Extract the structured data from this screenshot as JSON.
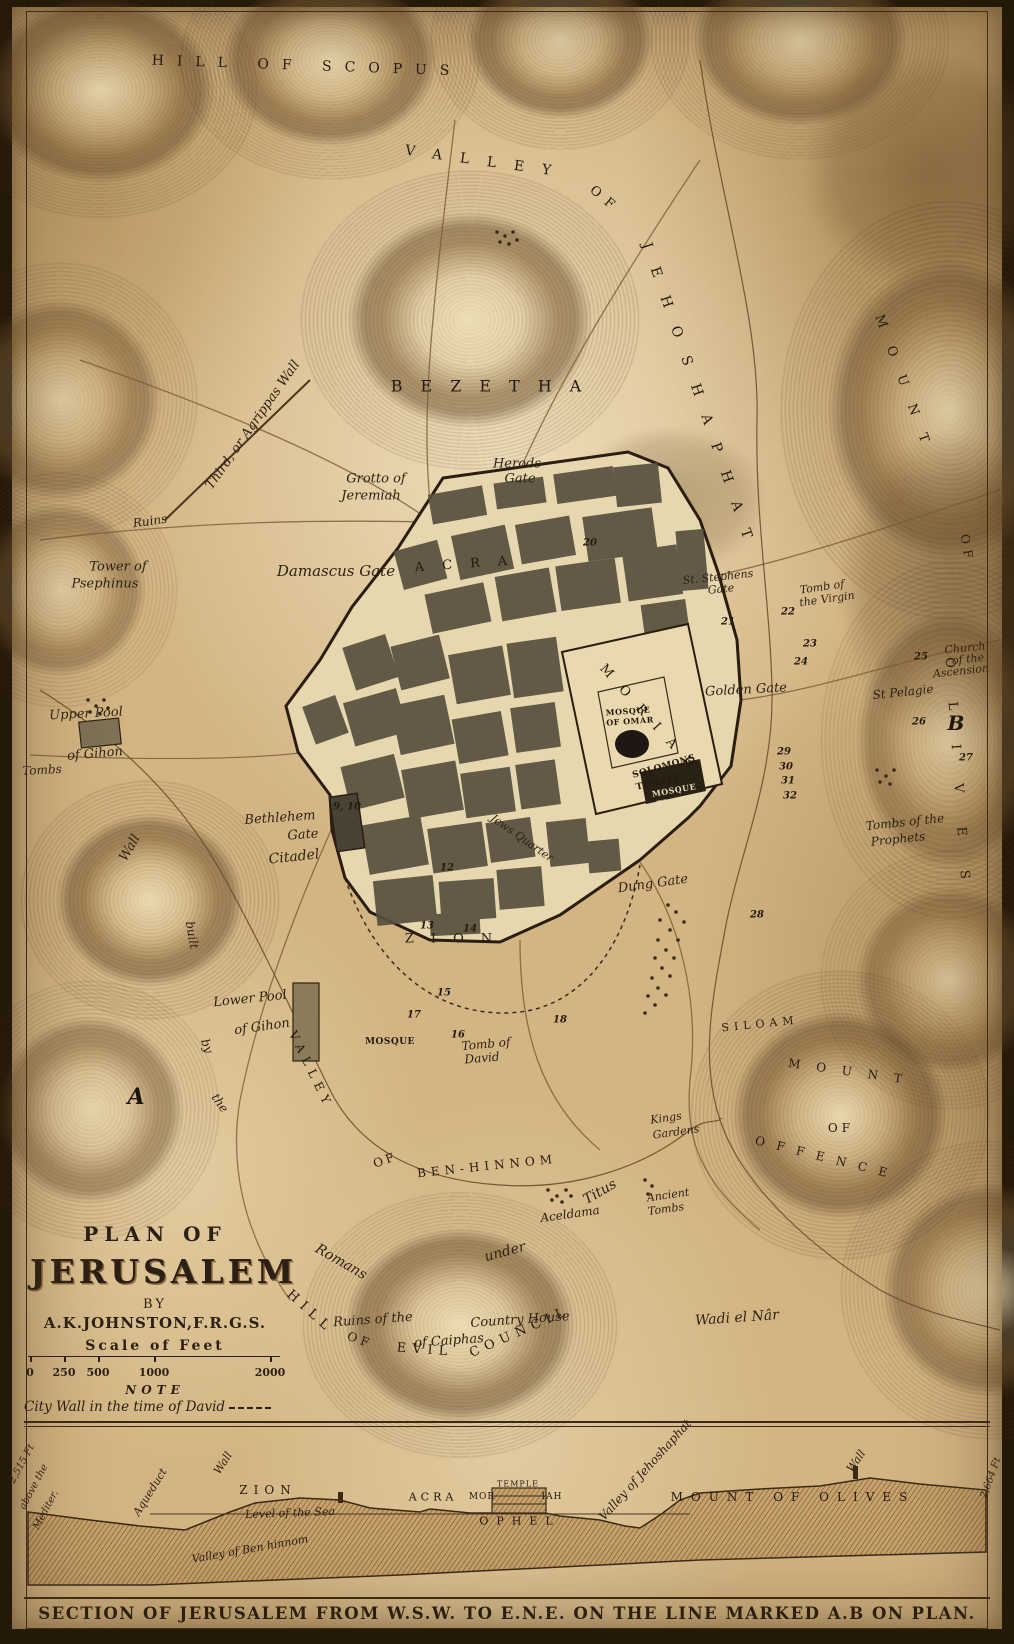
{
  "title_block": {
    "line1": "PLAN OF",
    "title": "JERUSALEM",
    "by": "BY",
    "author": "A.K.JOHNSTON,F.R.G.S.",
    "scale_heading": "Scale of Feet",
    "scale_ticks": [
      {
        "t": "0",
        "x": 30
      },
      {
        "t": "250",
        "x": 64
      },
      {
        "t": "500",
        "x": 98
      },
      {
        "t": "1000",
        "x": 154
      },
      {
        "t": "2000",
        "x": 270
      }
    ],
    "note_heading": "NOTE",
    "note_text": "City Wall in the time of David"
  },
  "section": {
    "caption": "SECTION OF JERUSALEM FROM W.S.W. TO E.N.E. ON THE LINE MARKED A.B ON PLAN.",
    "labels": [
      {
        "t": "2,515 Ft",
        "x": 22,
        "y": 1464,
        "r": -62,
        "s": 10,
        "k": "i"
      },
      {
        "t": "above the",
        "x": 34,
        "y": 1487,
        "r": -62,
        "s": 10,
        "k": "i"
      },
      {
        "t": "Mediter.",
        "x": 46,
        "y": 1510,
        "r": -62,
        "s": 10,
        "k": "i"
      },
      {
        "t": "Aqueduct",
        "x": 150,
        "y": 1492,
        "r": -58,
        "s": 11,
        "k": "i"
      },
      {
        "t": "Wall",
        "x": 223,
        "y": 1463,
        "r": -58,
        "s": 11,
        "k": "i"
      },
      {
        "t": "ZION",
        "x": 268,
        "y": 1490,
        "r": 0,
        "s": 12,
        "k": "c",
        "ls": 6
      },
      {
        "t": "Level of the Sea",
        "x": 290,
        "y": 1513,
        "r": -2,
        "s": 11,
        "k": "i"
      },
      {
        "t": "Valley of Ben hinnom",
        "x": 250,
        "y": 1549,
        "r": -10,
        "s": 11,
        "k": "i"
      },
      {
        "t": "ACRA",
        "x": 433,
        "y": 1497,
        "r": 0,
        "s": 11,
        "k": "c",
        "ls": 4
      },
      {
        "t": "MOR",
        "x": 482,
        "y": 1497,
        "r": 0,
        "s": 9,
        "k": "c",
        "ls": 1
      },
      {
        "t": "TEMPLE",
        "x": 518,
        "y": 1484,
        "r": 0,
        "s": 8,
        "k": "c",
        "ls": 1
      },
      {
        "t": "IAH",
        "x": 552,
        "y": 1497,
        "r": 0,
        "s": 9,
        "k": "c",
        "ls": 1
      },
      {
        "t": "OPHEL",
        "x": 520,
        "y": 1521,
        "r": 0,
        "s": 11,
        "k": "c",
        "ls": 8
      },
      {
        "t": "Valley of Jehoshaphat",
        "x": 645,
        "y": 1470,
        "r": -48,
        "s": 12,
        "k": "i"
      },
      {
        "t": "MOUNT OF OLIVES",
        "x": 793,
        "y": 1497,
        "r": 0,
        "s": 12,
        "k": "c",
        "ls": 8
      },
      {
        "t": "Wall",
        "x": 856,
        "y": 1461,
        "r": -55,
        "s": 11,
        "k": "i"
      },
      {
        "t": "2,664 Ft",
        "x": 991,
        "y": 1478,
        "r": -70,
        "s": 10,
        "k": "i"
      }
    ]
  },
  "map": {
    "labels": [
      {
        "t": "HILL OF SCOPUS",
        "x": 307,
        "y": 66,
        "r": 2,
        "s": 14,
        "k": "c",
        "ls": 13
      },
      {
        "t": "VALLEY",
        "x": 487,
        "y": 162,
        "r": 8,
        "s": 14,
        "k": "c",
        "ls": 18
      },
      {
        "t": "OF",
        "x": 605,
        "y": 200,
        "r": 40,
        "s": 13,
        "k": "c",
        "ls": 8
      },
      {
        "t": "JEHOSHAPHAT",
        "x": 700,
        "y": 400,
        "r": 71,
        "s": 14,
        "k": "c",
        "ls": 20
      },
      {
        "t": "BEZETHA",
        "x": 495,
        "y": 386,
        "r": 0,
        "s": 16,
        "k": "c",
        "ls": 18
      },
      {
        "t": "MOUNT",
        "x": 905,
        "y": 388,
        "r": 70,
        "s": 13,
        "k": "c",
        "ls": 20
      },
      {
        "t": "OF",
        "x": 967,
        "y": 549,
        "r": 80,
        "s": 12,
        "k": "c",
        "ls": 6
      },
      {
        "t": "OLIVES",
        "x": 958,
        "y": 785,
        "r": 86,
        "s": 13,
        "k": "c",
        "ls": 34
      },
      {
        "t": "ACRA",
        "x": 470,
        "y": 564,
        "r": -4,
        "s": 13,
        "k": "c",
        "ls": 18
      },
      {
        "t": "MORIAH",
        "x": 652,
        "y": 722,
        "r": 48,
        "s": 13,
        "k": "c",
        "ls": 15
      },
      {
        "t": "ZION",
        "x": 457,
        "y": 939,
        "r": 0,
        "s": 13,
        "k": "c",
        "ls": 17
      },
      {
        "t": "SILOAM",
        "x": 760,
        "y": 1024,
        "r": -6,
        "s": 11,
        "k": "c",
        "ls": 5
      },
      {
        "t": "MOUNT",
        "x": 853,
        "y": 1072,
        "r": 8,
        "s": 12,
        "k": "c",
        "ls": 16
      },
      {
        "t": "OF",
        "x": 841,
        "y": 1128,
        "r": 0,
        "s": 12,
        "k": "c",
        "ls": 4
      },
      {
        "t": "OFFENCE",
        "x": 827,
        "y": 1158,
        "r": 14,
        "s": 12,
        "k": "c",
        "ls": 12
      },
      {
        "t": "VALLEY",
        "x": 311,
        "y": 1070,
        "r": 64,
        "s": 12,
        "k": "c",
        "ls": 6
      },
      {
        "t": "OF",
        "x": 385,
        "y": 1160,
        "r": -20,
        "s": 12,
        "k": "c",
        "ls": 3
      },
      {
        "t": "BEN-HINNOM",
        "x": 487,
        "y": 1166,
        "r": -6,
        "s": 12,
        "k": "c",
        "ls": 5
      },
      {
        "t": "HILL",
        "x": 310,
        "y": 1312,
        "r": 42,
        "s": 13,
        "k": "c",
        "ls": 6
      },
      {
        "t": "OF",
        "x": 360,
        "y": 1340,
        "r": 20,
        "s": 12,
        "k": "c",
        "ls": 4
      },
      {
        "t": "EVIL",
        "x": 425,
        "y": 1350,
        "r": 4,
        "s": 13,
        "k": "c",
        "ls": 6
      },
      {
        "t": "COUNCIL",
        "x": 520,
        "y": 1332,
        "r": -24,
        "s": 13,
        "k": "c",
        "ls": 6
      },
      {
        "t": "MOSQUE",
        "x": 628,
        "y": 711,
        "r": -4,
        "s": 8,
        "k": "t"
      },
      {
        "t": "OF OMAR",
        "x": 630,
        "y": 721,
        "r": -4,
        "s": 8,
        "k": "t"
      },
      {
        "t": "SOLOMONS",
        "x": 664,
        "y": 767,
        "r": -16,
        "s": 9,
        "k": "t"
      },
      {
        "t": "TEMPLE",
        "x": 659,
        "y": 783,
        "r": -12,
        "s": 9,
        "k": "t"
      },
      {
        "t": "MOSQUE",
        "x": 674,
        "y": 790,
        "r": -10,
        "s": 8,
        "k": "tv"
      },
      {
        "t": "EL-AKSA",
        "x": 678,
        "y": 800,
        "r": -10,
        "s": 8,
        "k": "tv"
      },
      {
        "t": "MOSQUE",
        "x": 390,
        "y": 1042,
        "r": 0,
        "s": 9,
        "k": "t"
      },
      {
        "t": "Grotto of",
        "x": 376,
        "y": 479,
        "r": 0,
        "s": 13,
        "k": "i"
      },
      {
        "t": "Jeremiah",
        "x": 371,
        "y": 496,
        "r": 0,
        "s": 13,
        "k": "i"
      },
      {
        "t": "Herods",
        "x": 517,
        "y": 464,
        "r": 0,
        "s": 13,
        "k": "i"
      },
      {
        "t": "Gate",
        "x": 520,
        "y": 479,
        "r": 0,
        "s": 13,
        "k": "i"
      },
      {
        "t": "Damascus Gate",
        "x": 336,
        "y": 571,
        "r": 0,
        "s": 15,
        "k": "i"
      },
      {
        "t": "Ruins",
        "x": 150,
        "y": 521,
        "r": -8,
        "s": 12,
        "k": "i"
      },
      {
        "t": "Third, or Agrippas Wall",
        "x": 253,
        "y": 425,
        "r": -55,
        "s": 13,
        "k": "i"
      },
      {
        "t": "Tower of",
        "x": 118,
        "y": 567,
        "r": 0,
        "s": 13,
        "k": "i"
      },
      {
        "t": "Psephinus",
        "x": 105,
        "y": 584,
        "r": 0,
        "s": 13,
        "k": "i"
      },
      {
        "t": "St. Stephens",
        "x": 718,
        "y": 577,
        "r": -6,
        "s": 11,
        "k": "i"
      },
      {
        "t": "Gate",
        "x": 721,
        "y": 589,
        "r": -6,
        "s": 11,
        "k": "i"
      },
      {
        "t": "Tomb of",
        "x": 822,
        "y": 587,
        "r": -8,
        "s": 11,
        "k": "i"
      },
      {
        "t": "the Virgin",
        "x": 827,
        "y": 599,
        "r": -8,
        "s": 11,
        "k": "i"
      },
      {
        "t": "Golden Gate",
        "x": 746,
        "y": 690,
        "r": -3,
        "s": 13,
        "k": "i"
      },
      {
        "t": "Church",
        "x": 965,
        "y": 648,
        "r": -6,
        "s": 11,
        "k": "i"
      },
      {
        "t": "of the",
        "x": 968,
        "y": 659,
        "r": -6,
        "s": 11,
        "k": "i"
      },
      {
        "t": "Ascension",
        "x": 961,
        "y": 671,
        "r": -6,
        "s": 11,
        "k": "i"
      },
      {
        "t": "St Pelagie",
        "x": 903,
        "y": 692,
        "r": -6,
        "s": 12,
        "k": "i"
      },
      {
        "t": "Tombs of the",
        "x": 905,
        "y": 822,
        "r": -6,
        "s": 12,
        "k": "i"
      },
      {
        "t": "Prophets",
        "x": 898,
        "y": 839,
        "r": -6,
        "s": 12,
        "k": "i"
      },
      {
        "t": "Upper Pool",
        "x": 86,
        "y": 714,
        "r": -3,
        "s": 13,
        "k": "i"
      },
      {
        "t": "of Gihon",
        "x": 95,
        "y": 754,
        "r": -5,
        "s": 13,
        "k": "i"
      },
      {
        "t": "Tombs",
        "x": 42,
        "y": 770,
        "r": -3,
        "s": 12,
        "k": "i"
      },
      {
        "t": "Wall",
        "x": 130,
        "y": 848,
        "r": -60,
        "s": 13,
        "k": "i"
      },
      {
        "t": "built",
        "x": 192,
        "y": 935,
        "r": 80,
        "s": 12,
        "k": "i"
      },
      {
        "t": "by",
        "x": 207,
        "y": 1046,
        "r": 70,
        "s": 12,
        "k": "i"
      },
      {
        "t": "the",
        "x": 220,
        "y": 1103,
        "r": 55,
        "s": 12,
        "k": "i"
      },
      {
        "t": "Romans",
        "x": 341,
        "y": 1262,
        "r": 30,
        "s": 14,
        "k": "i"
      },
      {
        "t": "under",
        "x": 505,
        "y": 1252,
        "r": -15,
        "s": 14,
        "k": "i"
      },
      {
        "t": "Titus",
        "x": 600,
        "y": 1192,
        "r": -30,
        "s": 14,
        "k": "i"
      },
      {
        "t": "Bethlehem",
        "x": 280,
        "y": 818,
        "r": -4,
        "s": 13,
        "k": "i"
      },
      {
        "t": "Gate",
        "x": 303,
        "y": 835,
        "r": -4,
        "s": 13,
        "k": "i"
      },
      {
        "t": "Citadel",
        "x": 294,
        "y": 857,
        "r": -6,
        "s": 14,
        "k": "i"
      },
      {
        "t": "Jews Quarter",
        "x": 522,
        "y": 838,
        "r": 35,
        "s": 11,
        "k": "i"
      },
      {
        "t": "Dung Gate",
        "x": 653,
        "y": 884,
        "r": -8,
        "s": 13,
        "k": "i"
      },
      {
        "t": "Lower Pool",
        "x": 250,
        "y": 999,
        "r": -6,
        "s": 13,
        "k": "i"
      },
      {
        "t": "of Gihon",
        "x": 262,
        "y": 1027,
        "r": -8,
        "s": 13,
        "k": "i"
      },
      {
        "t": "Tomb of",
        "x": 486,
        "y": 1044,
        "r": -5,
        "s": 12,
        "k": "i"
      },
      {
        "t": "David",
        "x": 482,
        "y": 1058,
        "r": -5,
        "s": 12,
        "k": "i"
      },
      {
        "t": "Kings",
        "x": 666,
        "y": 1118,
        "r": -8,
        "s": 11,
        "k": "i"
      },
      {
        "t": "Gardens",
        "x": 676,
        "y": 1132,
        "r": -8,
        "s": 11,
        "k": "i"
      },
      {
        "t": "Aceldama",
        "x": 570,
        "y": 1214,
        "r": -8,
        "s": 12,
        "k": "i"
      },
      {
        "t": "Ancient",
        "x": 668,
        "y": 1195,
        "r": -8,
        "s": 11,
        "k": "i"
      },
      {
        "t": "Tombs",
        "x": 666,
        "y": 1209,
        "r": -8,
        "s": 11,
        "k": "i"
      },
      {
        "t": "Ruins of the",
        "x": 373,
        "y": 1320,
        "r": -4,
        "s": 13,
        "k": "i"
      },
      {
        "t": "Country House",
        "x": 520,
        "y": 1320,
        "r": -4,
        "s": 13,
        "k": "i"
      },
      {
        "t": "of Caiphas",
        "x": 449,
        "y": 1341,
        "r": -4,
        "s": 13,
        "k": "i"
      },
      {
        "t": "Wadi el Nâr",
        "x": 737,
        "y": 1318,
        "r": -4,
        "s": 14,
        "k": "i"
      },
      {
        "t": "9, 10",
        "x": 347,
        "y": 807,
        "r": 0,
        "s": 10,
        "k": "n"
      },
      {
        "t": "12",
        "x": 447,
        "y": 868,
        "r": 0,
        "s": 10,
        "k": "n"
      },
      {
        "t": "13",
        "x": 427,
        "y": 926,
        "r": 0,
        "s": 10,
        "k": "n"
      },
      {
        "t": "14",
        "x": 470,
        "y": 929,
        "r": 0,
        "s": 10,
        "k": "n"
      },
      {
        "t": "15",
        "x": 444,
        "y": 993,
        "r": 0,
        "s": 10,
        "k": "n"
      },
      {
        "t": "16",
        "x": 458,
        "y": 1035,
        "r": 0,
        "s": 10,
        "k": "n"
      },
      {
        "t": "17",
        "x": 414,
        "y": 1015,
        "r": 0,
        "s": 10,
        "k": "n"
      },
      {
        "t": "18",
        "x": 560,
        "y": 1020,
        "r": 0,
        "s": 10,
        "k": "n"
      },
      {
        "t": "20",
        "x": 590,
        "y": 543,
        "r": 0,
        "s": 10,
        "k": "n"
      },
      {
        "t": "21",
        "x": 728,
        "y": 622,
        "r": 0,
        "s": 10,
        "k": "n"
      },
      {
        "t": "22",
        "x": 788,
        "y": 612,
        "r": 0,
        "s": 10,
        "k": "n"
      },
      {
        "t": "23",
        "x": 810,
        "y": 644,
        "r": 0,
        "s": 10,
        "k": "n"
      },
      {
        "t": "24",
        "x": 801,
        "y": 662,
        "r": 0,
        "s": 10,
        "k": "n"
      },
      {
        "t": "25",
        "x": 921,
        "y": 657,
        "r": 0,
        "s": 10,
        "k": "n"
      },
      {
        "t": "26",
        "x": 919,
        "y": 722,
        "r": 0,
        "s": 10,
        "k": "n"
      },
      {
        "t": "27",
        "x": 966,
        "y": 758,
        "r": 0,
        "s": 10,
        "k": "n"
      },
      {
        "t": "28",
        "x": 757,
        "y": 915,
        "r": 0,
        "s": 10,
        "k": "n"
      },
      {
        "t": "29",
        "x": 784,
        "y": 752,
        "r": 0,
        "s": 10,
        "k": "n"
      },
      {
        "t": "30",
        "x": 786,
        "y": 767,
        "r": 0,
        "s": 10,
        "k": "n"
      },
      {
        "t": "31",
        "x": 788,
        "y": 781,
        "r": 0,
        "s": 10,
        "k": "n"
      },
      {
        "t": "32",
        "x": 790,
        "y": 796,
        "r": 0,
        "s": 10,
        "k": "n"
      },
      {
        "t": "A",
        "x": 136,
        "y": 1097,
        "r": 0,
        "s": 22,
        "k": "m"
      },
      {
        "t": "B",
        "x": 956,
        "y": 723,
        "r": 0,
        "s": 20,
        "k": "m"
      }
    ]
  },
  "colors": {
    "paper": "#d3b584",
    "ink": "#2e2213",
    "terrain": "#7a5c36",
    "city_block": "#57503e",
    "frame": "#241809"
  }
}
